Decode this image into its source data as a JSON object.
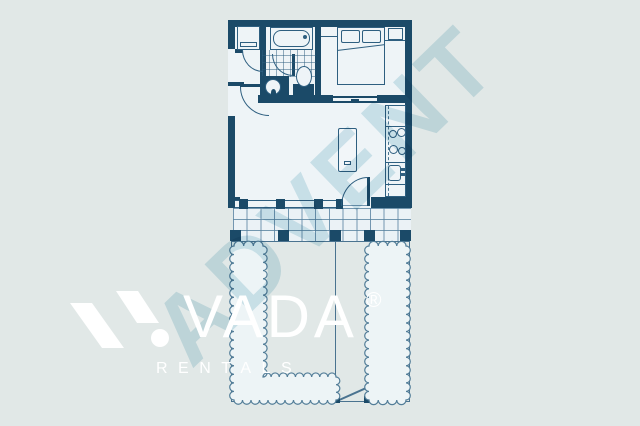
{
  "watermark": {
    "text": "ADVENT"
  },
  "brand": {
    "name": "VADA",
    "registered_mark": "®",
    "tagline": "RENTALS"
  },
  "floorplan": {
    "fixtures": [
      "washer",
      "bathtub",
      "toilet",
      "vanity-sink",
      "bed",
      "pillows",
      "wardrobe",
      "sliding-door",
      "entry-door",
      "closet-door",
      "bathroom-door",
      "patio-door",
      "kitchen-counter",
      "stove",
      "kitchen-sink",
      "island",
      "window-band",
      "deck",
      "garden-fence",
      "hedge",
      "gate"
    ]
  },
  "colors": {
    "background": "#e1e8e7",
    "wall": "#1b4a68",
    "interior_fill": "#eef4f7",
    "fixture_line": "#2e5f80",
    "thin_line": "#557f9e",
    "garden_line": "#4a7390",
    "hedge_fill": "#edf4f6",
    "watermark": "#d6e9ef",
    "logo": "#ffffff"
  }
}
